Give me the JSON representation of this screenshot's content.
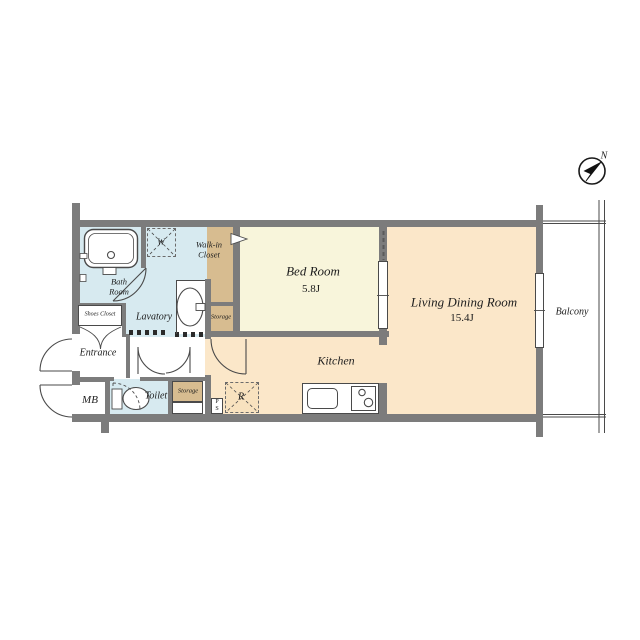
{
  "title": "apartment-floor-plan",
  "compass": {
    "north_label": "N"
  },
  "colors": {
    "wall": "#7c7c7c",
    "line": "#4a4a4a",
    "bedroom_fill": "#f8f5db",
    "living_fill": "#fbe7c9",
    "closet_fill": "#d7bc90",
    "wet_area_fill": "#d7eaf0",
    "background": "#ffffff"
  },
  "rooms": {
    "bed_room": {
      "name": "Bed Room",
      "size": "5.8J"
    },
    "living_dining_room": {
      "name": "Living Dining Room",
      "size": "15.4J"
    },
    "kitchen": {
      "name": "Kitchen"
    },
    "balcony": {
      "name": "Balcony"
    },
    "bath_room": {
      "line1": "Bath",
      "line2": "Room"
    },
    "walk_in_closet": {
      "line1": "Walk-in",
      "line2": "Closet"
    },
    "lavatory": {
      "name": "Lavatory"
    },
    "toilet": {
      "name": "Toilet"
    },
    "entrance": {
      "name": "Entrance"
    },
    "shoes_closet": {
      "name": "Shoes Closet"
    },
    "mb": {
      "name": "MB"
    },
    "storage_upper": {
      "name": "Storage"
    },
    "storage_lower": {
      "name": "Storage"
    },
    "washer": {
      "name": "W"
    },
    "refrigerator": {
      "name": "R"
    },
    "pipe_space": {
      "line1": "P",
      "line2": "S"
    }
  }
}
